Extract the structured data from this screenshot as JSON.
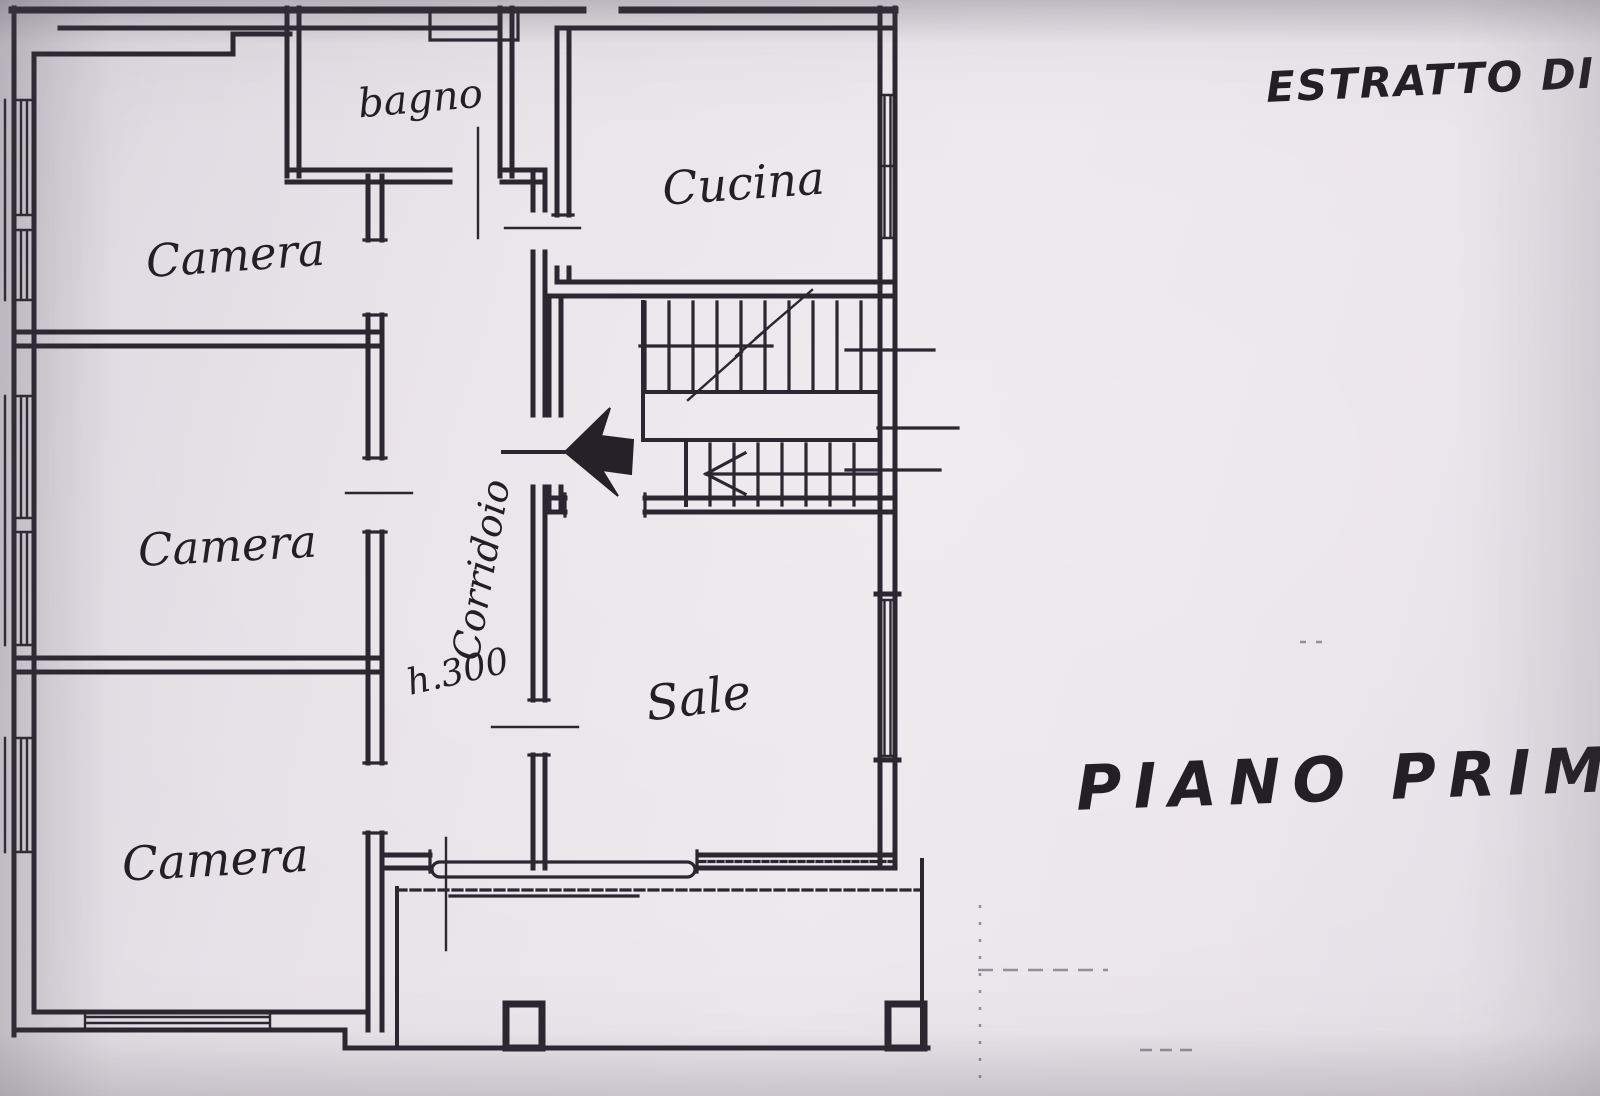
{
  "annotations": {
    "map_extract": "ESTRATTO DI MAP",
    "floor": "PIANO PRIMO"
  },
  "rooms": {
    "camera_top": "Camera",
    "camera_middle": "Camera",
    "camera_bottom": "Camera",
    "bagno": "bagno",
    "cucina": "Cucina",
    "sala": "Sale",
    "corridoio": "Corridoio",
    "corridor_height": "h.300"
  },
  "colors": {
    "paper": "#e8e3e9",
    "ink": "#2b2630",
    "faint_line": "#948d9b"
  }
}
